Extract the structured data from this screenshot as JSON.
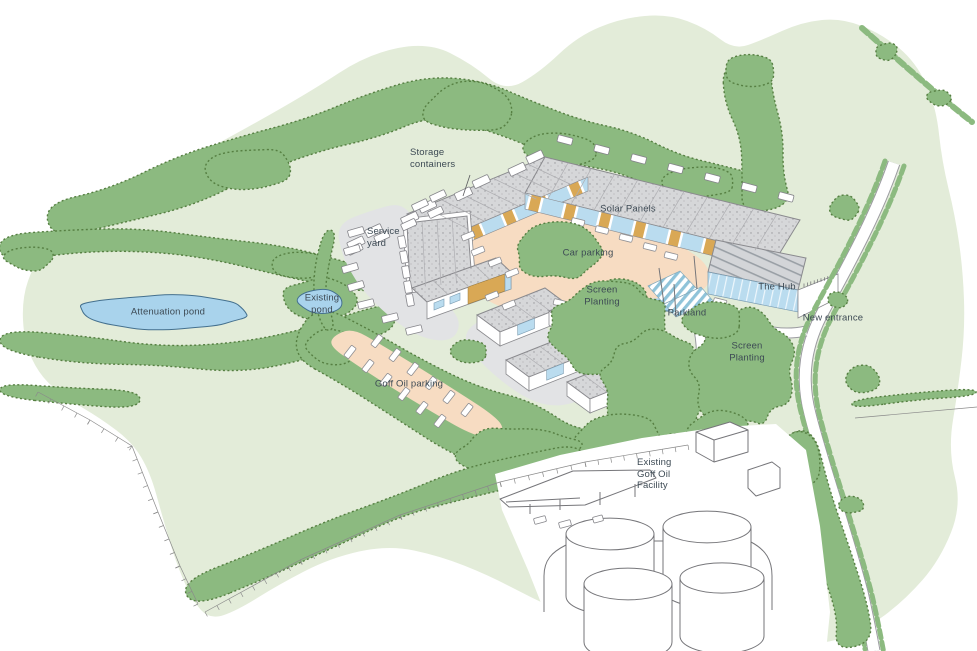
{
  "labels": {
    "storage_containers": "Storage\ncontainers",
    "service_yard": "Service\nyard",
    "solar_panels": "Solar Panels",
    "car_parking": "Car parking",
    "screen_planting_mid": "Screen\nPlanting",
    "existing_pond": "Existing\npond",
    "attenuation_pond": "Attenuation pond",
    "goff_oil_parking": "Goff Oil parking",
    "parkland": "Parkland",
    "the_hub": "The Hub",
    "new_entrance": "New entrance",
    "screen_planting_right": "Screen\nPlanting",
    "existing_goff_oil_facility": "Existing\nGoff Oil\nFacility"
  },
  "colors": {
    "background": "#ffffff",
    "field_green": "#e3ecd9",
    "woodland_green": "#8cba80",
    "woodland_edge": "#567f42",
    "water_blue": "#a9d3ec",
    "water_edge": "#44708e",
    "parking_peach": "#f7dcc2",
    "yard_grey": "#e2e3e5",
    "roof_grey": "#d6d7d9",
    "glazing_blue": "#badcef",
    "timber_tan": "#d9a855",
    "label_text": "#3d4a54"
  }
}
